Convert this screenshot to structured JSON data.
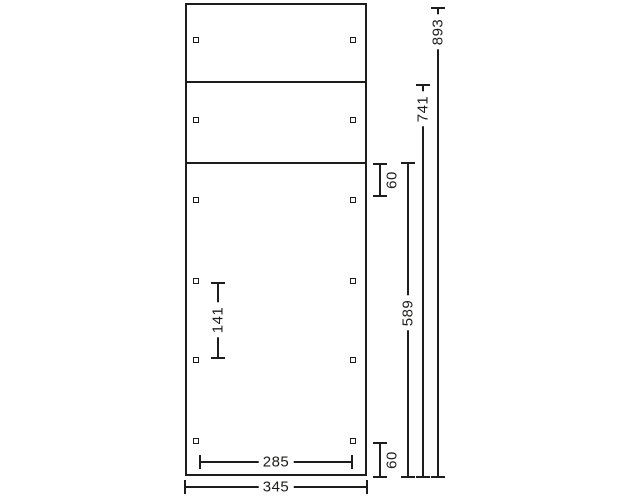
{
  "drawing": {
    "kind": "panel-dimension-drawing",
    "line_color": "#1d1d1b",
    "background_color": "#ffffff",
    "panel": {
      "x": 185,
      "y": 3,
      "width": 182,
      "height": 473,
      "dividers_y": [
        81,
        162
      ]
    },
    "holes": {
      "size": 6,
      "cols_x": [
        196,
        353
      ],
      "rows_y": [
        40,
        120,
        200,
        281,
        360,
        441
      ]
    },
    "dims": [
      {
        "name": "dim-overall-height",
        "orient": "v",
        "x": 438,
        "from": 8,
        "to": 477,
        "label": "893",
        "label_at": 32,
        "label_pos": "on"
      },
      {
        "name": "dim-upper-boards-height",
        "orient": "v",
        "x": 423,
        "from": 85,
        "to": 477,
        "label": "741",
        "label_at": 109,
        "label_pos": "on"
      },
      {
        "name": "dim-lower-panel-height",
        "orient": "v",
        "x": 408,
        "from": 163,
        "to": 477,
        "label": "589",
        "label_at": 313,
        "label_pos": "on"
      },
      {
        "name": "dim-top-hole-offset",
        "orient": "v",
        "x": 380,
        "from": 164,
        "to": 196,
        "label": "60",
        "label_at": 180,
        "label_pos": "side"
      },
      {
        "name": "dim-bottom-hole-offset",
        "orient": "v",
        "x": 380,
        "from": 443,
        "to": 477,
        "label": "60",
        "label_at": 460,
        "label_pos": "side"
      },
      {
        "name": "dim-hole-spacing-vertical",
        "orient": "v",
        "x": 218,
        "from": 283,
        "to": 358,
        "label": "141",
        "label_at": 320,
        "label_pos": "on"
      },
      {
        "name": "dim-hole-spacing-horizontal",
        "orient": "h",
        "y": 462,
        "from": 200,
        "to": 352,
        "label": "285",
        "label_at": 276,
        "label_pos": "on"
      },
      {
        "name": "dim-overall-width",
        "orient": "h",
        "y": 487,
        "from": 185,
        "to": 367,
        "label": "345",
        "label_at": 276,
        "label_pos": "on"
      }
    ]
  }
}
